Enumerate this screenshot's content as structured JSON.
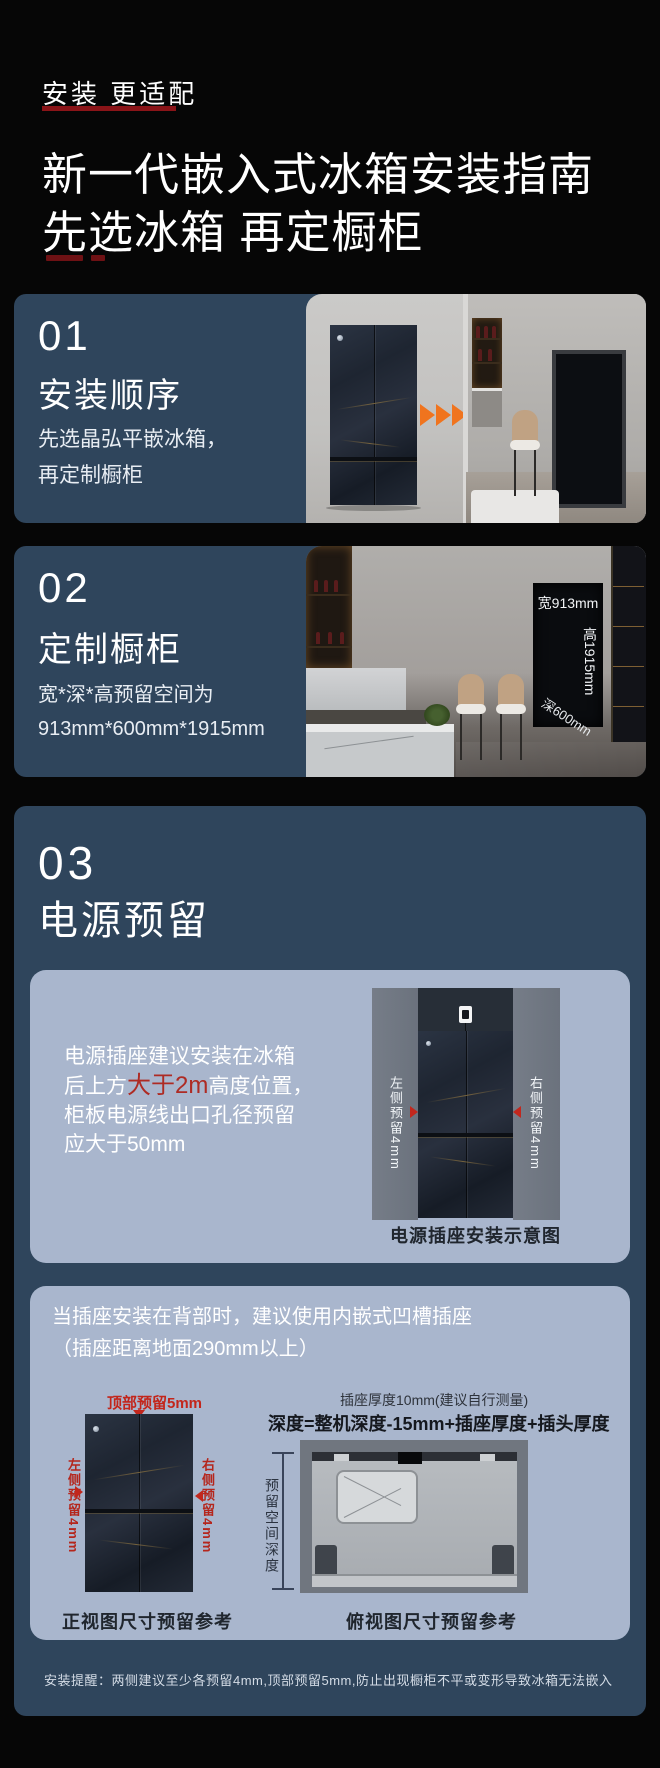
{
  "colors": {
    "background": "#060606",
    "card_blue": "#2f455c",
    "inner_card_blue": "#a9b6cd",
    "accent_red": "#ae2b24",
    "dark_red_underline": "#8a1418",
    "arrow_orange": "#f0741e",
    "white": "#ffffff"
  },
  "header": {
    "eyebrow": "安装 更适配",
    "title_line1": "新一代嵌入式冰箱安装指南",
    "title_line2": "先选冰箱 再定橱柜"
  },
  "section1": {
    "number": "01",
    "title": "安装顺序",
    "body_line1": "先选晶弘平嵌冰箱，",
    "body_line2": "再定制橱柜"
  },
  "section2": {
    "number": "02",
    "title": "定制橱柜",
    "body_line1": "宽*深*高预留空间为",
    "body_line2": "913mm*600mm*1915mm",
    "label_width": "宽913mm",
    "label_height": "高1915mm",
    "label_depth": "深600mm"
  },
  "section3": {
    "number": "03",
    "title": "电源预留",
    "power_card": {
      "line1": "电源插座建议安装在冰箱",
      "line2_pre": "后上方",
      "line2_highlight": "大于2m",
      "line2_post": "高度位置，",
      "line3": "柜板电源线出口孔径预留",
      "line4": "应大于50mm",
      "label_left": "左侧预留4mm",
      "label_right": "右侧预留4mm",
      "caption": "电源插座安装示意图"
    },
    "recess_card": {
      "line1": "当插座安装在背部时，建议使用内嵌式凹槽插座",
      "line2": "（插座距离地面290mm以上）",
      "front_view": {
        "label_top": "顶部预留5mm",
        "label_left": "左侧预留4mm",
        "label_right": "右侧预留4mm",
        "caption": "正视图尺寸预留参考"
      },
      "top_view": {
        "note": "插座厚度10mm(建议自行测量)",
        "formula": "深度=整机深度-15mm+插座厚度+插头厚度",
        "dim_label": "预留空间深度",
        "caption": "俯视图尺寸预留参考"
      }
    },
    "footnote": "安装提醒：两侧建议至少各预留4mm,顶部预留5mm,防止出现橱柜不平或变形导致冰箱无法嵌入"
  }
}
